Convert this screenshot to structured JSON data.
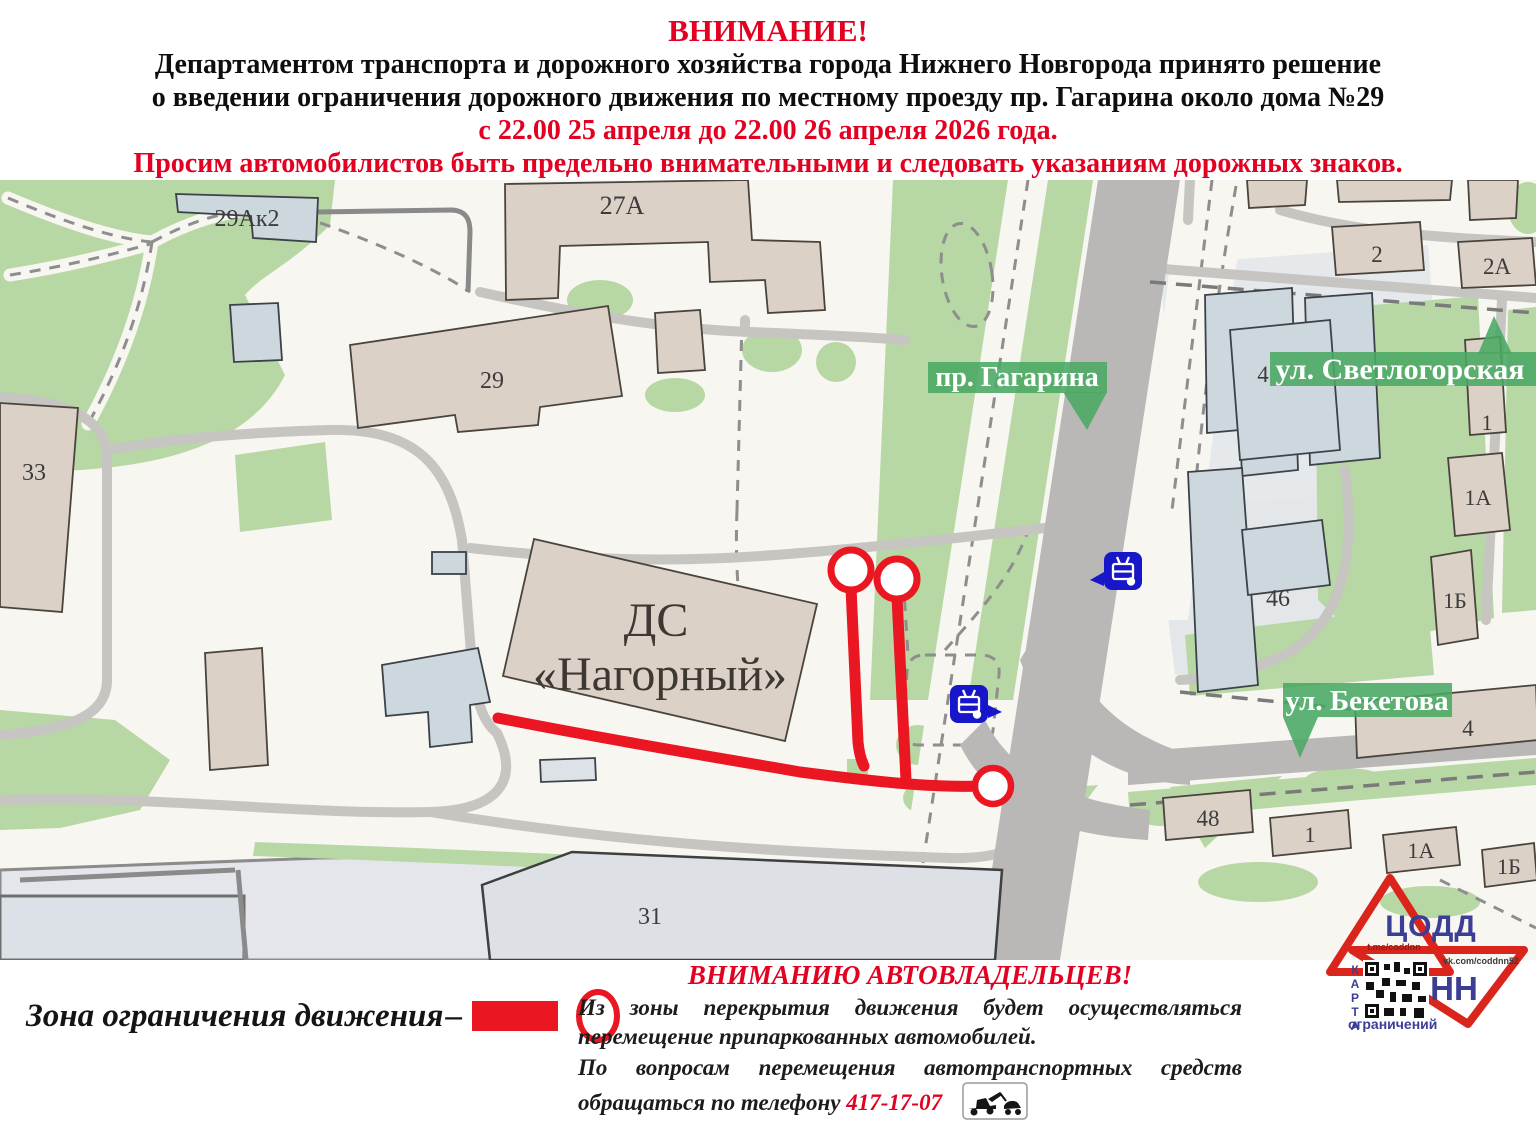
{
  "header": {
    "attention": "ВНИМАНИЕ!",
    "line1": "Департаментом транспорта и дорожного хозяйства города Нижнего Новгорода принято решение",
    "line2": "о введении ограничения дорожного движения по местному проезду пр. Гагарина около дома №29",
    "line3": "с 22.00 25 апреля до 22.00 26 апреля 2026 года.",
    "line4": "Просим автомобилистов быть предельно внимательными и следовать указаниям дорожных знаков."
  },
  "map": {
    "labels": {
      "gagarina": "пр. Гагарина",
      "svetlogorskaya": "ул. Светлогорская",
      "beketova": "ул. Бекетова"
    },
    "ds_line1": "ДС",
    "ds_line2": "«Нагорный»",
    "buildings": {
      "b29ak2": "29Ак2",
      "b27a": "27А",
      "b29": "29",
      "b33": "33",
      "b2": "2",
      "b2a": "2А",
      "b4s": "4",
      "b1s": "1",
      "b1a": "1А",
      "b1b": "1Б",
      "b46": "46",
      "b4b": "4",
      "b48": "48",
      "b1": "1",
      "b1a2": "1А",
      "b1b2": "1Б",
      "b31": "31"
    }
  },
  "legend": {
    "zone_label": "Зона ограничения движения",
    "dash": "–"
  },
  "notice": {
    "title": "ВНИМАНИЮ АВТОВЛАДЕЛЬЦЕВ!",
    "p1": "Из зоны перекрытия движения будет осуществляться перемещение припаркованных автомобилей.",
    "p2": "По вопросам перемещения автотранспортных средств обращаться по телефону",
    "phone": "417-17-07"
  },
  "logo": {
    "org": "ЦОДД",
    "city": "НН",
    "tg": "t.me/coddnn",
    "vk": "vk.com/coddnn52",
    "karta": "КАРТА",
    "restrictions": "ограничений"
  },
  "icons": {
    "transport_stop": "tram-stop-icon",
    "tow_truck": "tow-truck-icon",
    "restriction_endpoint": "restriction-endpoint-circle"
  },
  "colors": {
    "alert_red": "#e30021",
    "zone_red": "#ea1621",
    "label_green": "#4aa863",
    "park_green": "#b7d7a4",
    "road_gray": "#c6c5c2",
    "major_road_gray": "#b9b8b6",
    "building_beige": "#dbd1c7",
    "building_gray_blue": "#cdd7de",
    "stop_blue": "#1717c9",
    "logo_red": "#da251d",
    "logo_blue": "#3c3e96"
  }
}
